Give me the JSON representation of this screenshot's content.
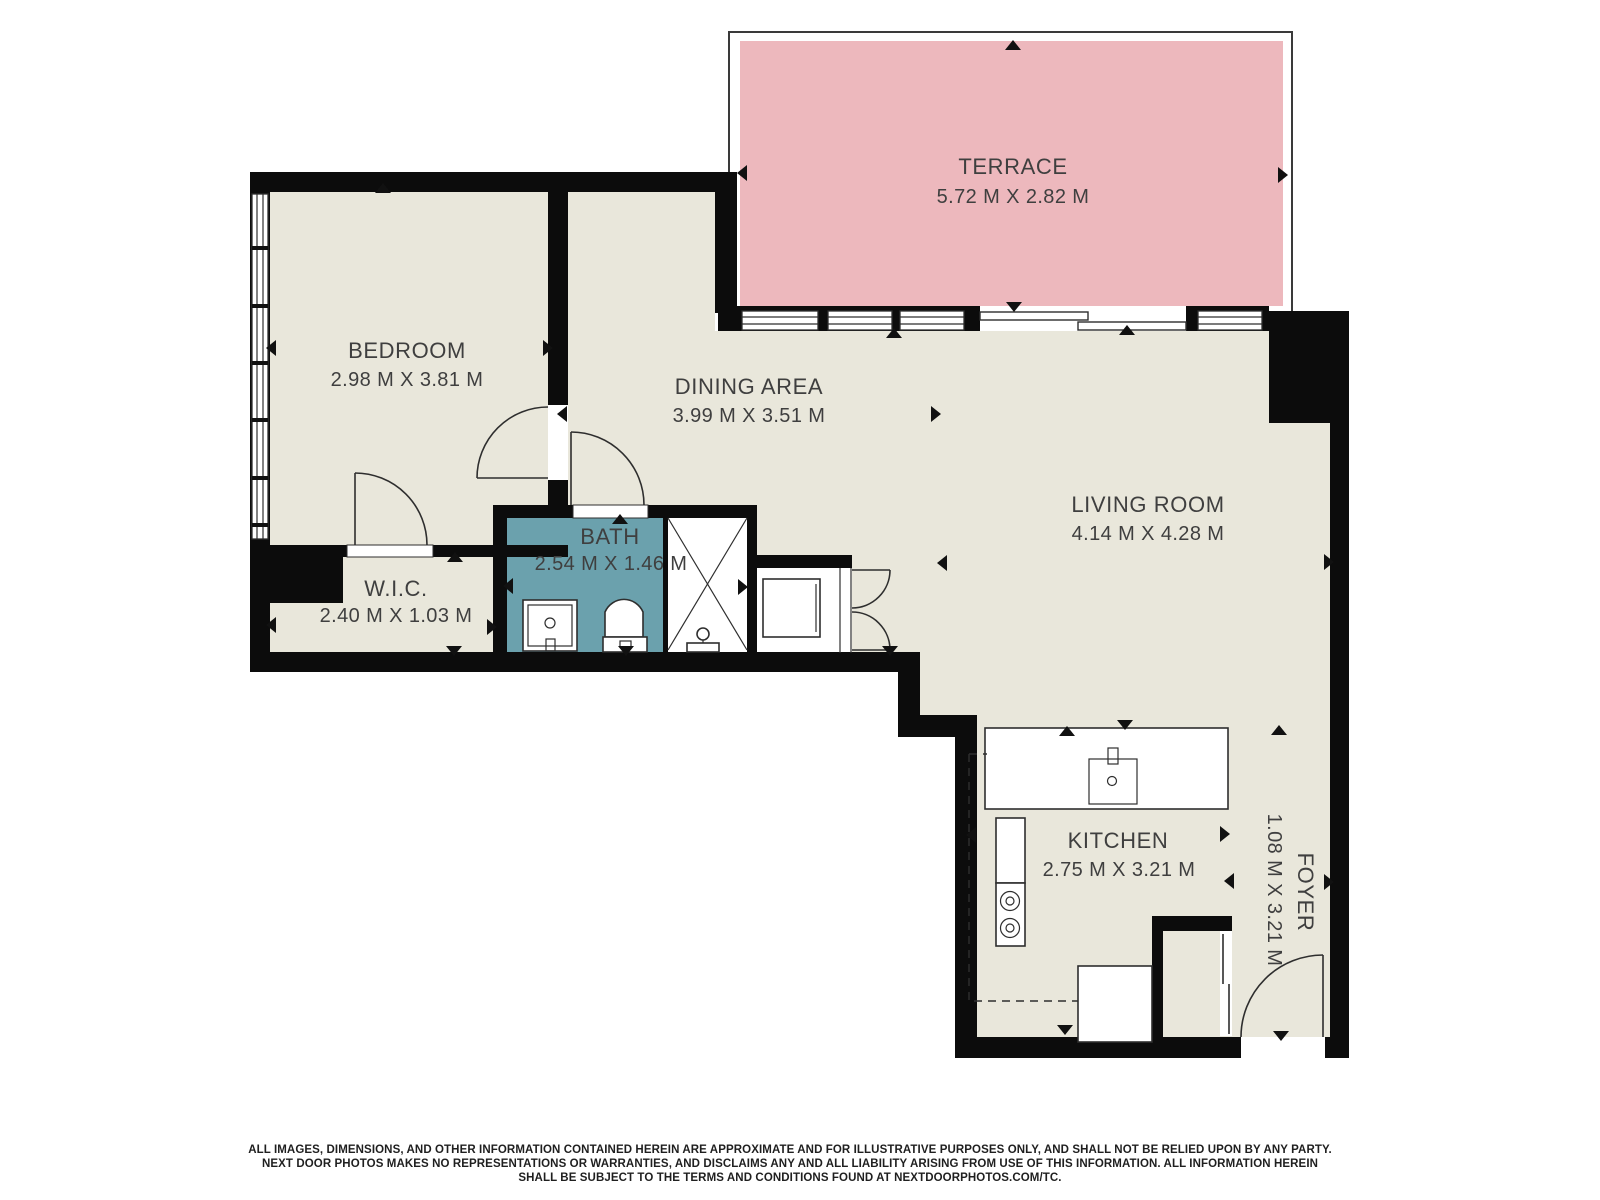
{
  "plan": {
    "colors": {
      "wall": "#0c0c0c",
      "floor": "#e9e7db",
      "terrace": "#edb8bd",
      "bath": "#6ba1ad",
      "line": "#2e2e2e",
      "text": "#3f3f3f"
    },
    "rooms": [
      {
        "id": "terrace",
        "name": "TERRACE",
        "dims": "5.72 M X 2.82 M"
      },
      {
        "id": "bedroom",
        "name": "BEDROOM",
        "dims": "2.98 M X 3.81 M"
      },
      {
        "id": "dining-area",
        "name": "DINING AREA",
        "dims": "3.99 M X 3.51 M"
      },
      {
        "id": "living-room",
        "name": "LIVING ROOM",
        "dims": "4.14 M X 4.28 M"
      },
      {
        "id": "bath",
        "name": "BATH",
        "dims": "2.54 M X 1.46 M"
      },
      {
        "id": "wic",
        "name": "W.I.C.",
        "dims": "2.40 M X 1.03 M"
      },
      {
        "id": "kitchen",
        "name": "KITCHEN",
        "dims": "2.75 M X 3.21 M"
      },
      {
        "id": "foyer",
        "name": "FOYER",
        "dims": "1.08 M X 3.21 M"
      }
    ]
  },
  "disclaimer": {
    "line1": "ALL IMAGES, DIMENSIONS, AND OTHER INFORMATION CONTAINED HEREIN ARE APPROXIMATE AND FOR ILLUSTRATIVE PURPOSES ONLY, AND SHALL NOT BE RELIED UPON BY ANY PARTY.",
    "line2": "NEXT DOOR PHOTOS MAKES NO REPRESENTATIONS OR WARRANTIES, AND DISCLAIMS ANY AND ALL LIABILITY ARISING FROM USE OF THIS INFORMATION. ALL INFORMATION HEREIN",
    "line3": "SHALL BE SUBJECT TO THE TERMS AND CONDITIONS FOUND AT NEXTDOORPHOTOS.COM/TC."
  }
}
